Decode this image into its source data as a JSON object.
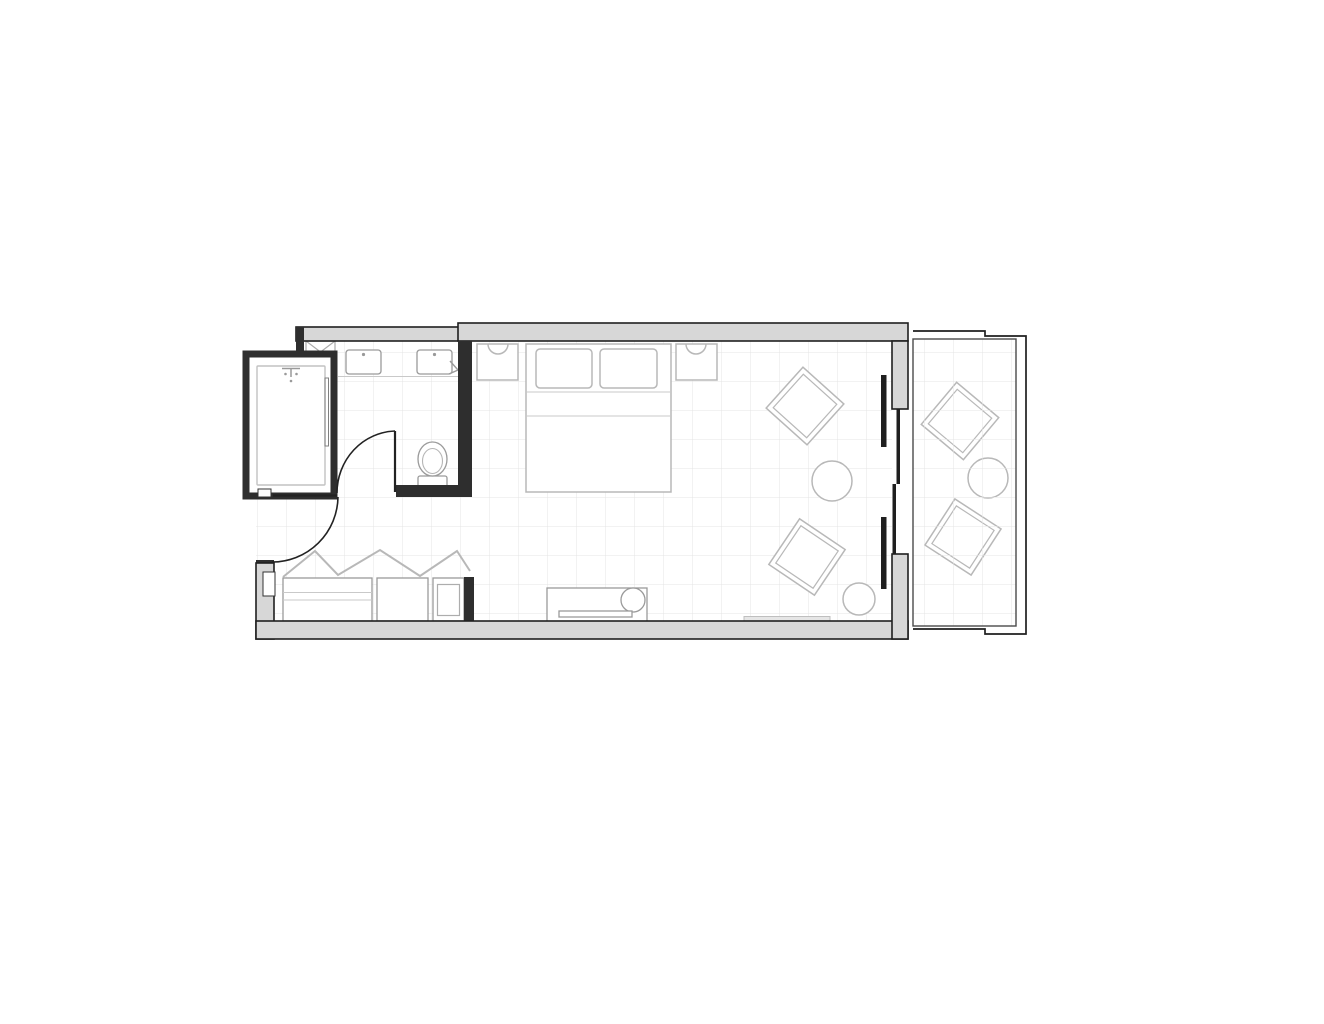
{
  "document": {
    "kind": "architectural-floor-plan",
    "visible_text": "none"
  },
  "palette": {
    "floor": "#ffffff",
    "wall_fill": "#d7d7d7",
    "wall_edge": "#1f1f1f",
    "partition": "#2e2e2e",
    "fixture": "#9a9a9a",
    "furniture": "#b8b8b8",
    "furniture_light": "#c9c9c9",
    "grid": "#e4e4e4",
    "glass": "#1f1f1f"
  },
  "floorplan": {
    "rooms": [
      {
        "name": "bathroom",
        "fixtures": [
          "bathtub-shower-enclosure",
          "shower-head",
          "glass-shower-door",
          "vanity-counter",
          "sink-left",
          "sink-right",
          "shaft-x-box",
          "towel-hook",
          "toilet",
          "swing-door"
        ]
      },
      {
        "name": "entry-vestibule",
        "fixtures": [
          "entry-swing-door",
          "closet-bifold-doors",
          "closet-hanging-section",
          "closet-open-shelf",
          "minibar-cabinet"
        ]
      },
      {
        "name": "bedroom",
        "fixtures": [
          "double-bed",
          "pillow-left",
          "pillow-right",
          "nightstand-left",
          "nightstand-right",
          "wall-sconce-left",
          "wall-sconce-right",
          "media-console",
          "sliding-glass-doors",
          "baseboard-sill"
        ]
      },
      {
        "name": "balcony",
        "fixtures": [
          "railing",
          "floor-grid"
        ]
      }
    ],
    "grid": {
      "spacing": 29,
      "offset_x": 25,
      "offset_y": 4
    },
    "lounge_chairs": [
      {
        "cx": 805,
        "cy": 406,
        "rot": 42
      },
      {
        "cx": 807,
        "cy": 557,
        "rot": 34
      },
      {
        "cx": 960,
        "cy": 421,
        "rot": 40
      },
      {
        "cx": 963,
        "cy": 537,
        "rot": 33
      }
    ],
    "chair": {
      "size": 55,
      "inner_inset": 5
    },
    "round_tables": [
      {
        "cx": 832,
        "cy": 481,
        "r": 20
      },
      {
        "cx": 988,
        "cy": 478,
        "r": 20
      }
    ],
    "stool": {
      "cx": 859,
      "cy": 599,
      "r": 16
    }
  }
}
